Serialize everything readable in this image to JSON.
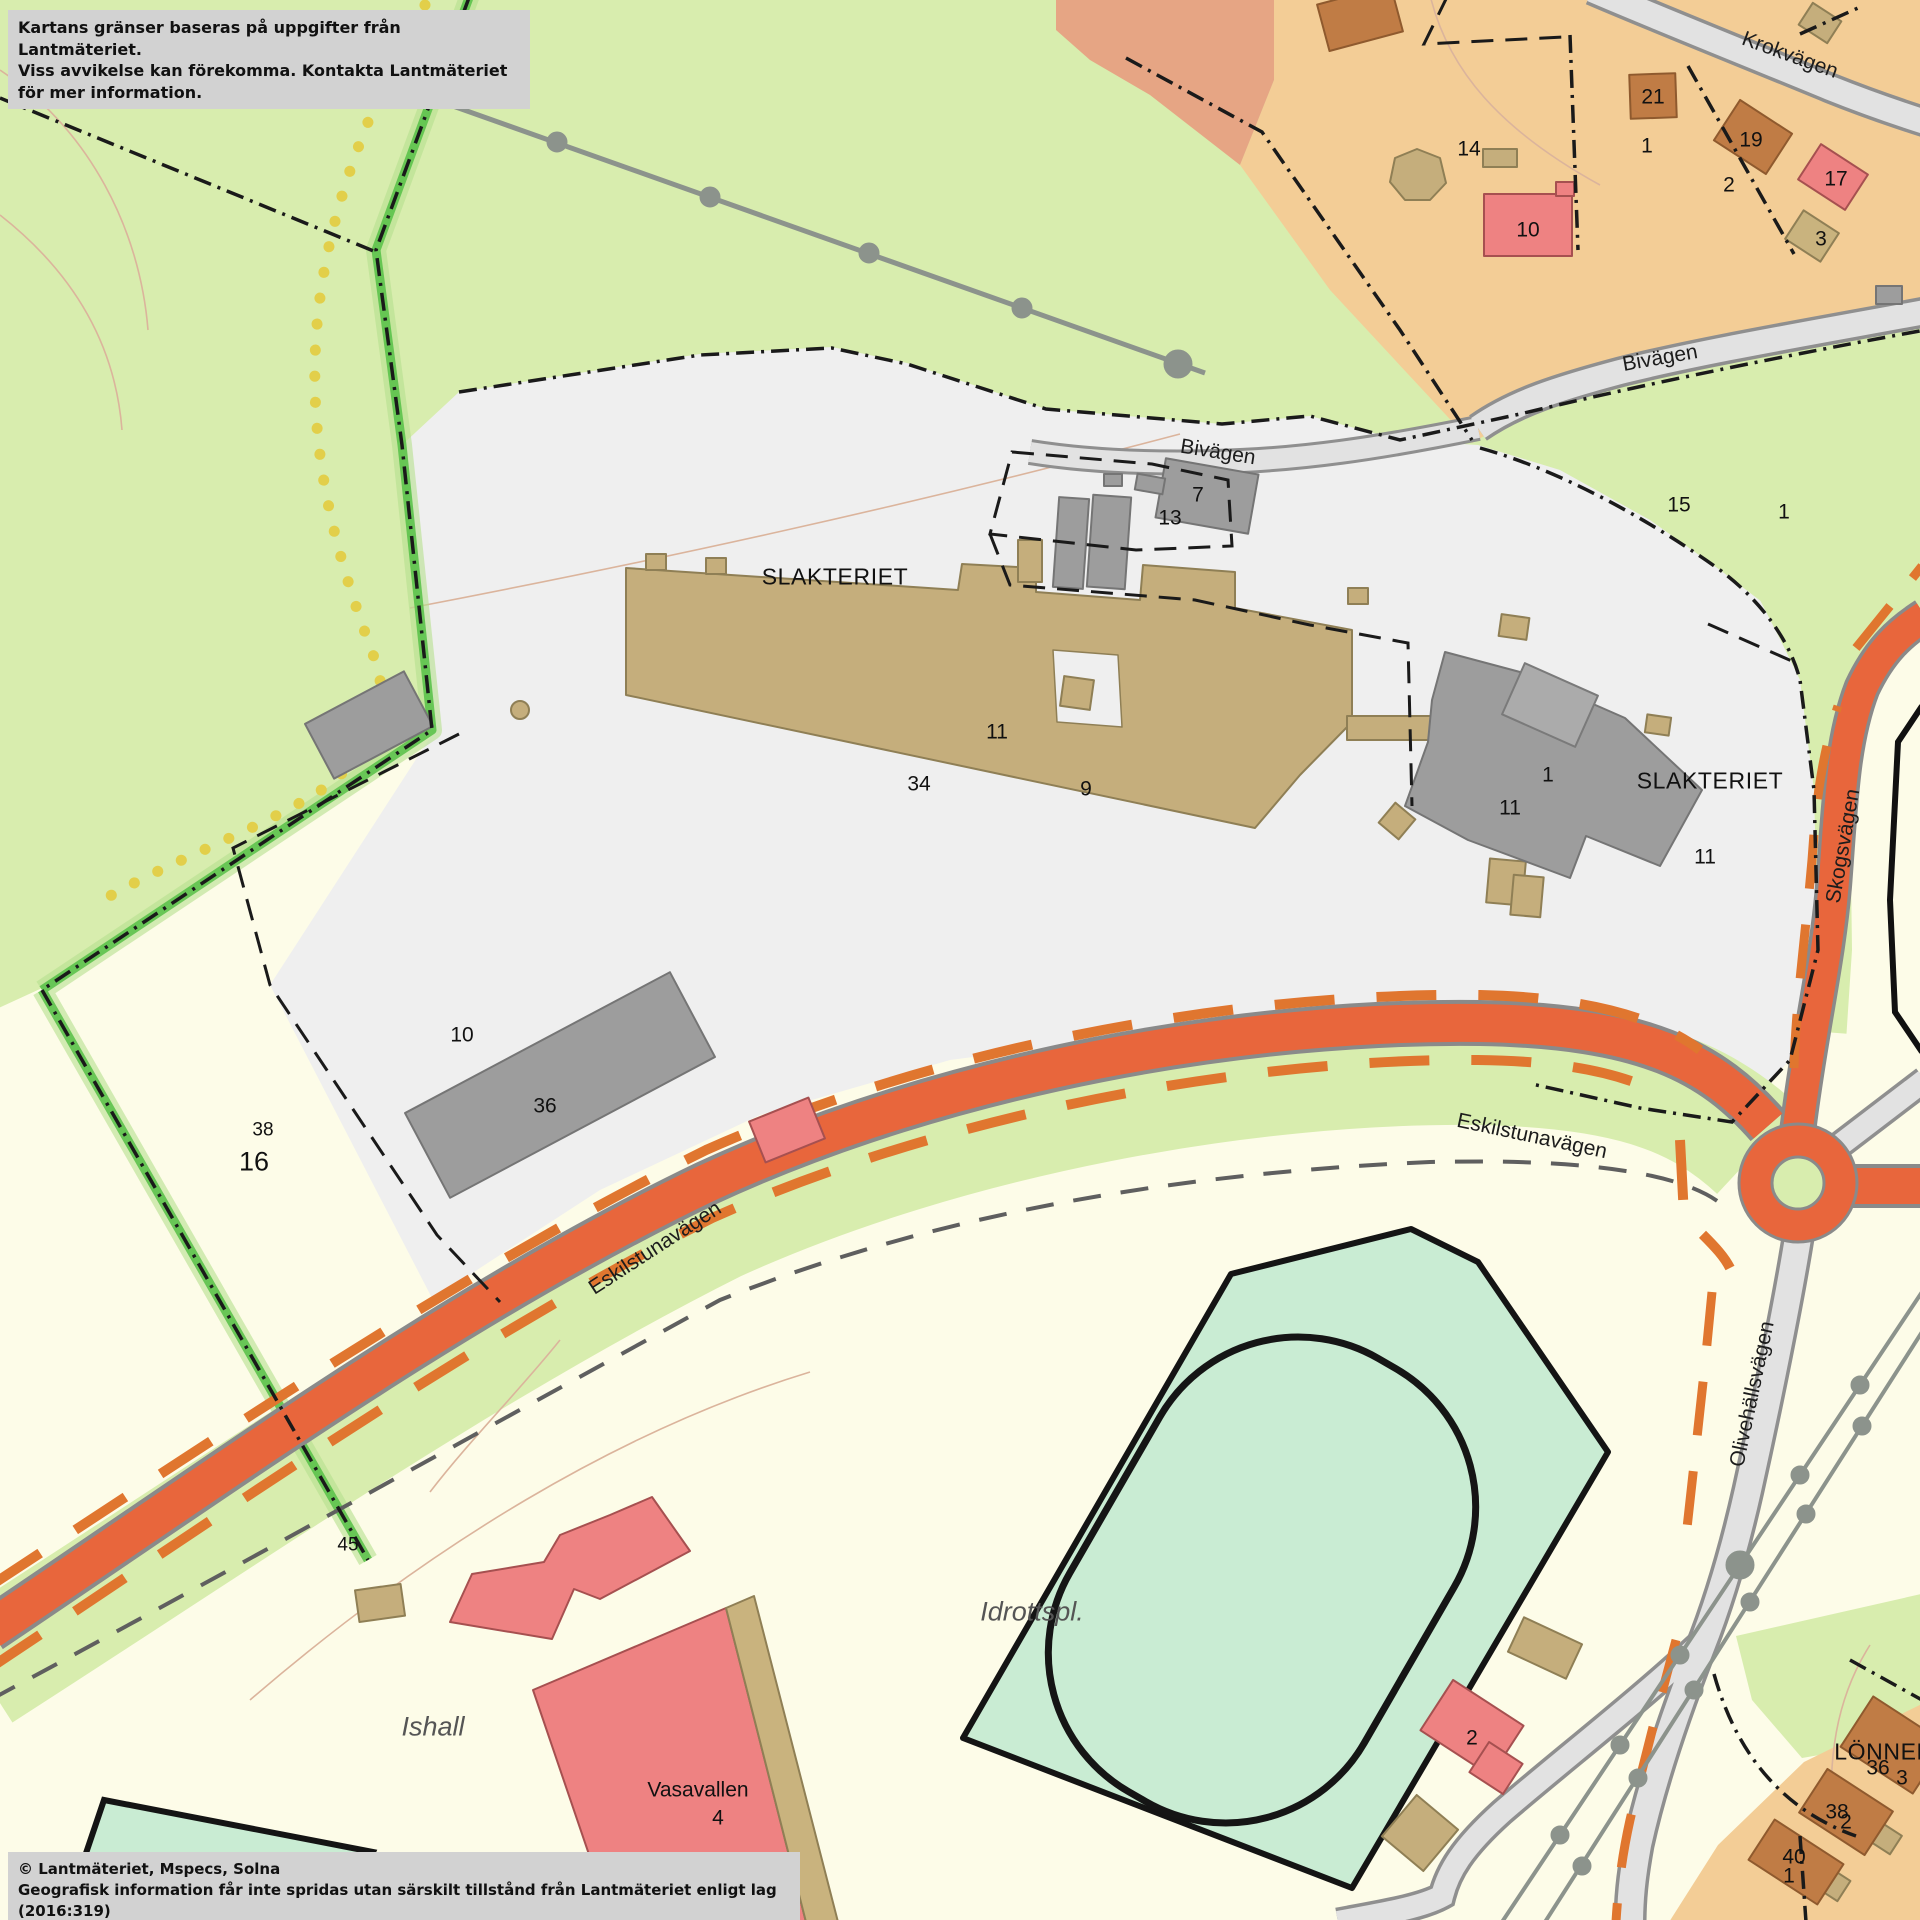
{
  "map": {
    "disclaimer_box": {
      "line1": "Kartans gränser baseras på uppgifter från Lantmäteriet.",
      "line2": "Viss avvikelse kan förekomma. Kontakta Lantmäteriet för mer information."
    },
    "attribution_box": {
      "line1": "© Lantmäteriet, Mspecs, Solna",
      "line2": "Geografisk information får inte spridas utan särskilt tillstånd från Lantmäteriet enligt lag (2016:319)"
    },
    "colors": {
      "parkland_green": "#d8edae",
      "field_mint": "#c9ecd3",
      "open_cream": "#fdfce8",
      "industrial_gray": "#efefef",
      "residential_tan": "#f3cd96",
      "residential_salmon": "#e6a584",
      "major_road_orange": "#e8663c",
      "cycleway_orange": "#e0762f",
      "minor_road_gray": "#e2e2e2",
      "building_brown": "#c07c45",
      "building_red": "#ee8282",
      "building_tan": "#c9b37e",
      "building_gray": "#9d9d9d",
      "boundary_green": "#5cc24b",
      "path_yellow": "#e2cf4a"
    },
    "labels": [
      {
        "text": "Krokvägen",
        "x": 1790,
        "y": 55,
        "rot": 20,
        "kind": "road"
      },
      {
        "text": "Bivägen",
        "x": 1660,
        "y": 358,
        "rot": -10,
        "kind": "road"
      },
      {
        "text": "Bivägen",
        "x": 1218,
        "y": 452,
        "rot": 9,
        "kind": "road"
      },
      {
        "text": "SLAKTERIET",
        "x": 835,
        "y": 577,
        "rot": 0,
        "kind": "place"
      },
      {
        "text": "SLAKTERIET",
        "x": 1710,
        "y": 781,
        "rot": 0,
        "kind": "place"
      },
      {
        "text": "7",
        "x": 1198,
        "y": 495,
        "rot": 0,
        "kind": "number"
      },
      {
        "text": "13",
        "x": 1170,
        "y": 518,
        "rot": 0,
        "kind": "number"
      },
      {
        "text": "11",
        "x": 997,
        "y": 732,
        "rot": 0,
        "kind": "number"
      },
      {
        "text": "34",
        "x": 919,
        "y": 784,
        "rot": 0,
        "kind": "number"
      },
      {
        "text": "9",
        "x": 1086,
        "y": 789,
        "rot": 0,
        "kind": "number"
      },
      {
        "text": "1",
        "x": 1548,
        "y": 775,
        "rot": 0,
        "kind": "number"
      },
      {
        "text": "11",
        "x": 1510,
        "y": 808,
        "rot": 0,
        "kind": "number"
      },
      {
        "text": "11",
        "x": 1705,
        "y": 857,
        "rot": 0,
        "kind": "number"
      },
      {
        "text": "15",
        "x": 1679,
        "y": 505,
        "rot": 0,
        "kind": "number"
      },
      {
        "text": "1",
        "x": 1784,
        "y": 512,
        "rot": 0,
        "kind": "number"
      },
      {
        "text": "21",
        "x": 1653,
        "y": 97,
        "rot": 0,
        "kind": "number"
      },
      {
        "text": "1",
        "x": 1647,
        "y": 146,
        "rot": 0,
        "kind": "number"
      },
      {
        "text": "19",
        "x": 1751,
        "y": 140,
        "rot": 0,
        "kind": "number"
      },
      {
        "text": "2",
        "x": 1729,
        "y": 185,
        "rot": 0,
        "kind": "number"
      },
      {
        "text": "17",
        "x": 1836,
        "y": 179,
        "rot": 0,
        "kind": "number"
      },
      {
        "text": "3",
        "x": 1821,
        "y": 239,
        "rot": 0,
        "kind": "number"
      },
      {
        "text": "14",
        "x": 1469,
        "y": 149,
        "rot": 0,
        "kind": "number"
      },
      {
        "text": "10",
        "x": 1528,
        "y": 230,
        "rot": 0,
        "kind": "number"
      },
      {
        "text": "10",
        "x": 462,
        "y": 1035,
        "rot": 0,
        "kind": "number"
      },
      {
        "text": "36",
        "x": 545,
        "y": 1106,
        "rot": 0,
        "kind": "number"
      },
      {
        "text": "38",
        "x": 263,
        "y": 1130,
        "rot": 0,
        "kind": "number-small"
      },
      {
        "text": "16",
        "x": 254,
        "y": 1162,
        "rot": 0,
        "kind": "number-big"
      },
      {
        "text": "45",
        "x": 348,
        "y": 1545,
        "rot": 0,
        "kind": "number-small"
      },
      {
        "text": "Ishall",
        "x": 433,
        "y": 1727,
        "rot": 0,
        "kind": "italic"
      },
      {
        "text": "Vasavallen",
        "x": 698,
        "y": 1790,
        "rot": 0,
        "kind": "name"
      },
      {
        "text": "4",
        "x": 718,
        "y": 1818,
        "rot": 0,
        "kind": "number"
      },
      {
        "text": "Idrottspl.",
        "x": 1032,
        "y": 1612,
        "rot": 0,
        "kind": "italic"
      },
      {
        "text": "2",
        "x": 1472,
        "y": 1738,
        "rot": 0,
        "kind": "number"
      },
      {
        "text": "LÖNNEN",
        "x": 1884,
        "y": 1752,
        "rot": 0,
        "kind": "place"
      },
      {
        "text": "36",
        "x": 1878,
        "y": 1768,
        "rot": 0,
        "kind": "number"
      },
      {
        "text": "3",
        "x": 1902,
        "y": 1778,
        "rot": 0,
        "kind": "number"
      },
      {
        "text": "38",
        "x": 1837,
        "y": 1812,
        "rot": 0,
        "kind": "number"
      },
      {
        "text": "2",
        "x": 1846,
        "y": 1822,
        "rot": 0,
        "kind": "number"
      },
      {
        "text": "40",
        "x": 1794,
        "y": 1857,
        "rot": 0,
        "kind": "number"
      },
      {
        "text": "1",
        "x": 1789,
        "y": 1876,
        "rot": 0,
        "kind": "number"
      },
      {
        "text": "Eskilstunavägen",
        "x": 655,
        "y": 1248,
        "rot": -33,
        "kind": "road"
      },
      {
        "text": "Eskilstunavägen",
        "x": 1532,
        "y": 1136,
        "rot": 12,
        "kind": "road"
      },
      {
        "text": "Skogsvägen",
        "x": 1843,
        "y": 846,
        "rot": -80,
        "kind": "road"
      },
      {
        "text": "Olivehällsvägen",
        "x": 1752,
        "y": 1394,
        "rot": -78,
        "kind": "road"
      }
    ]
  }
}
